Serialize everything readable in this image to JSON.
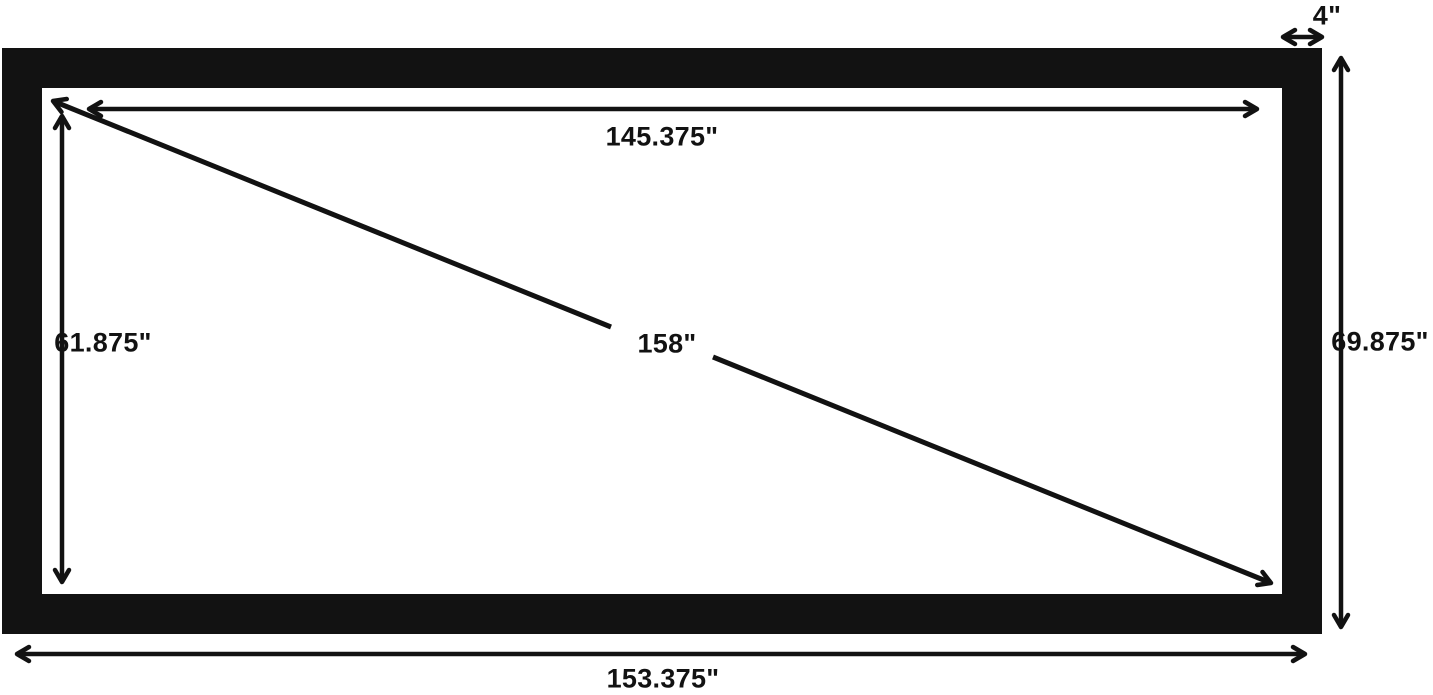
{
  "diagram": {
    "type": "projection-screen-dimension-diagram",
    "background_color": "#ffffff",
    "frame_color": "#121212",
    "line_color": "#121212",
    "dimensions": {
      "viewing_width": "145.375\"",
      "viewing_height": "61.875\"",
      "diagonal": "158\"",
      "outer_height": "69.875\"",
      "outer_width": "153.375\"",
      "frame_border_width": "4\""
    }
  }
}
